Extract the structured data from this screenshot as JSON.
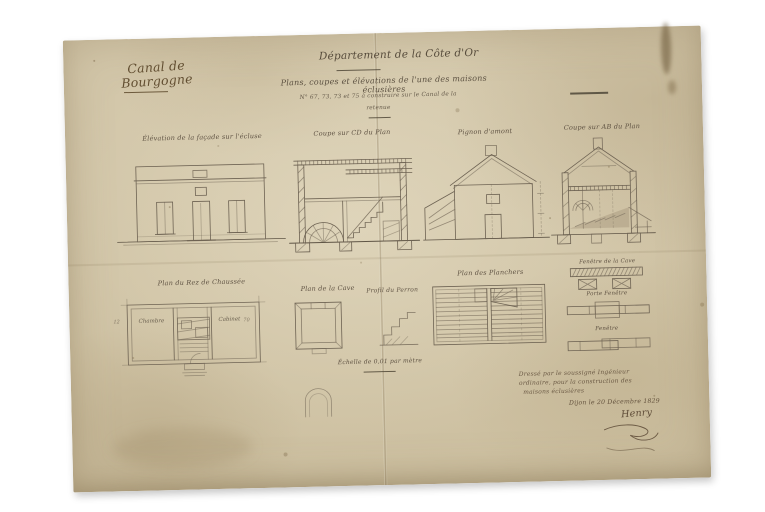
{
  "sheet": {
    "series_label": "Canal de Bourgogne",
    "header": {
      "department": "Département de la Côte d'Or",
      "title": "Plans, coupes et élévations de l'une des maisons éclusières",
      "subtitle": "N° 67, 73, 73 et 75 à construire sur le Canal de la",
      "subtitle2": "retenue"
    },
    "figures": {
      "row1": [
        {
          "label": "Élévation de la façade sur l'écluse"
        },
        {
          "label": "Coupe sur CD du Plan"
        },
        {
          "label": "Pignon d'amont"
        },
        {
          "label": "Coupe sur AB du Plan"
        }
      ],
      "row2": [
        {
          "label": "Plan du Rez de Chaussée"
        },
        {
          "label": "Plan de la Cave"
        },
        {
          "label": "Profil du Perron"
        },
        {
          "label": "Plan des Planchers"
        }
      ],
      "details": [
        {
          "label": "Fenêtre de la Cave"
        },
        {
          "label": "Porte Fenêtre"
        },
        {
          "label": "Fenêtre"
        }
      ],
      "rooms": {
        "left": "Chambre",
        "right": "Cabinet"
      },
      "dims": {
        "left": "12",
        "right": "70"
      }
    },
    "scale_note": "Échelle de 0,01 par mètre",
    "certification": {
      "line1": "Dressé par le soussigné Ingénieur",
      "line2": "ordinaire, pour la construction des",
      "line3": "maisons éclusières",
      "dateline": "Dijon le 20 Décembre 1829",
      "signature": "Henry"
    },
    "colors": {
      "paper": "#d2c6a9",
      "ink": "#5a4629",
      "pencil": "#6e6353"
    }
  }
}
